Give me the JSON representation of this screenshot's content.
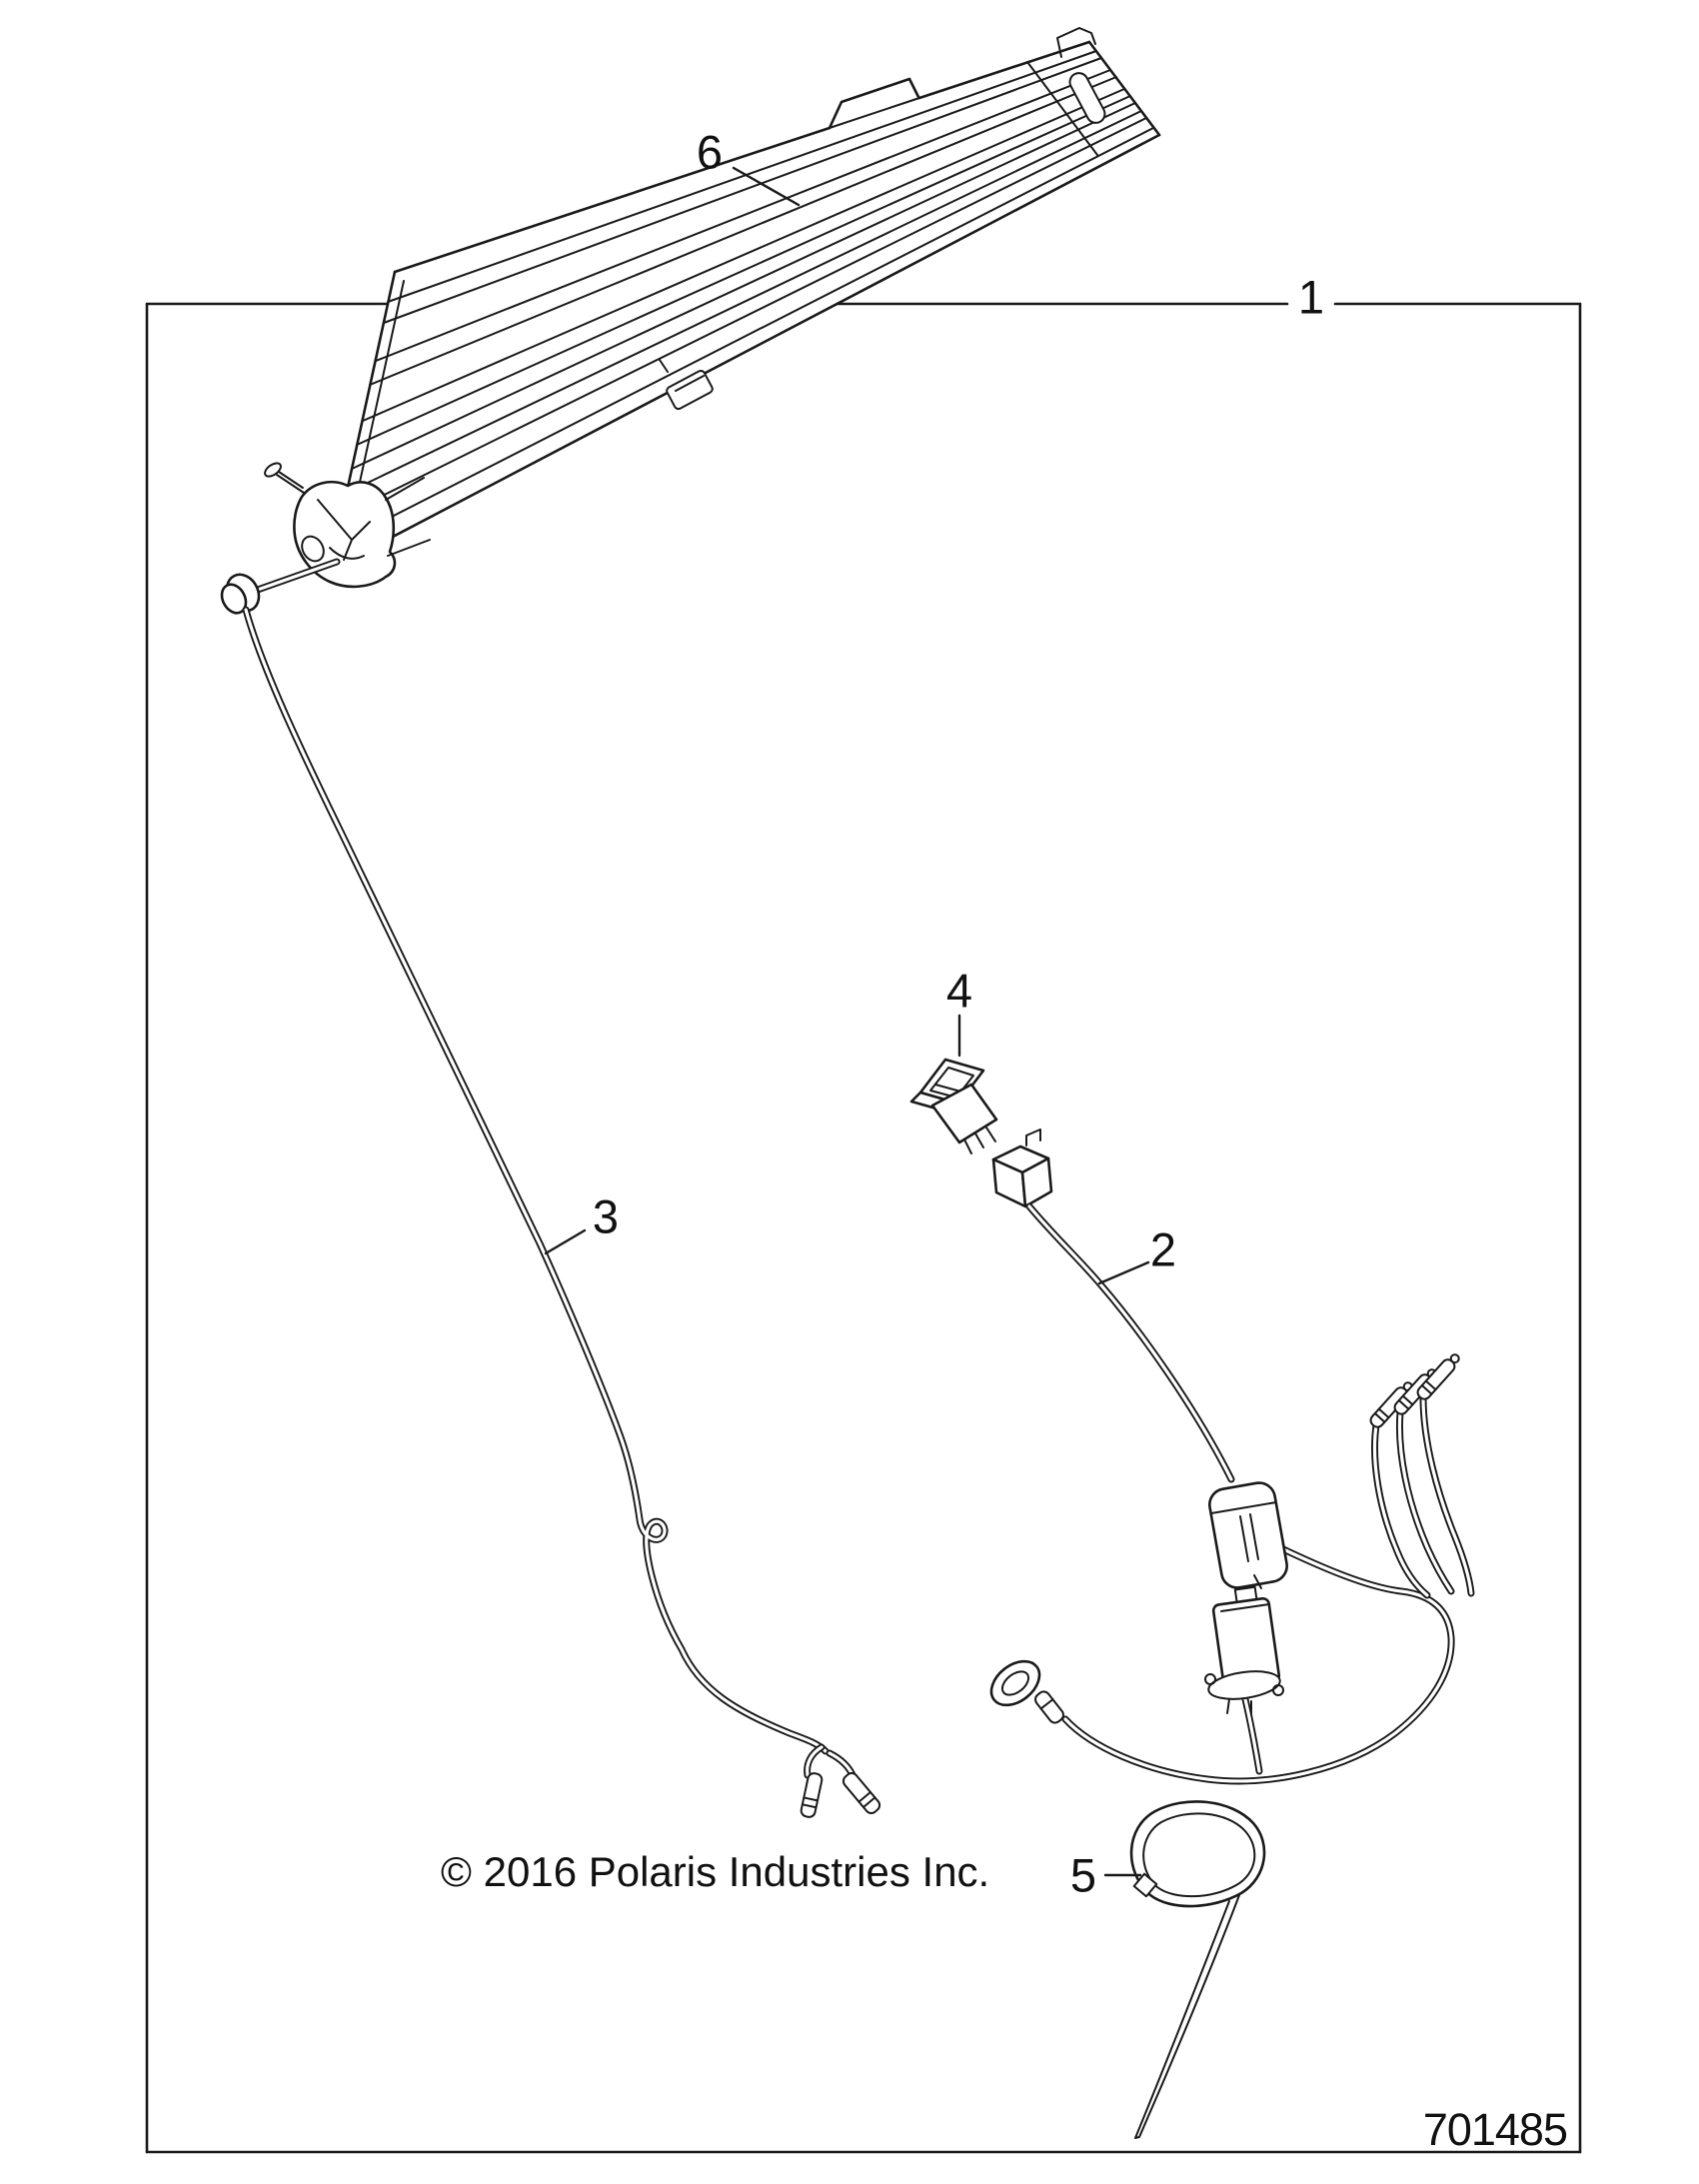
{
  "diagram": {
    "callouts": [
      {
        "label": "1"
      },
      {
        "label": "2"
      },
      {
        "label": "3"
      },
      {
        "label": "4"
      },
      {
        "label": "5"
      },
      {
        "label": "6"
      }
    ],
    "copyright": "© 2016 Polaris Industries Inc.",
    "part_number": "701485",
    "colors": {
      "line": "#1a1a1a",
      "background": "#ffffff"
    }
  }
}
